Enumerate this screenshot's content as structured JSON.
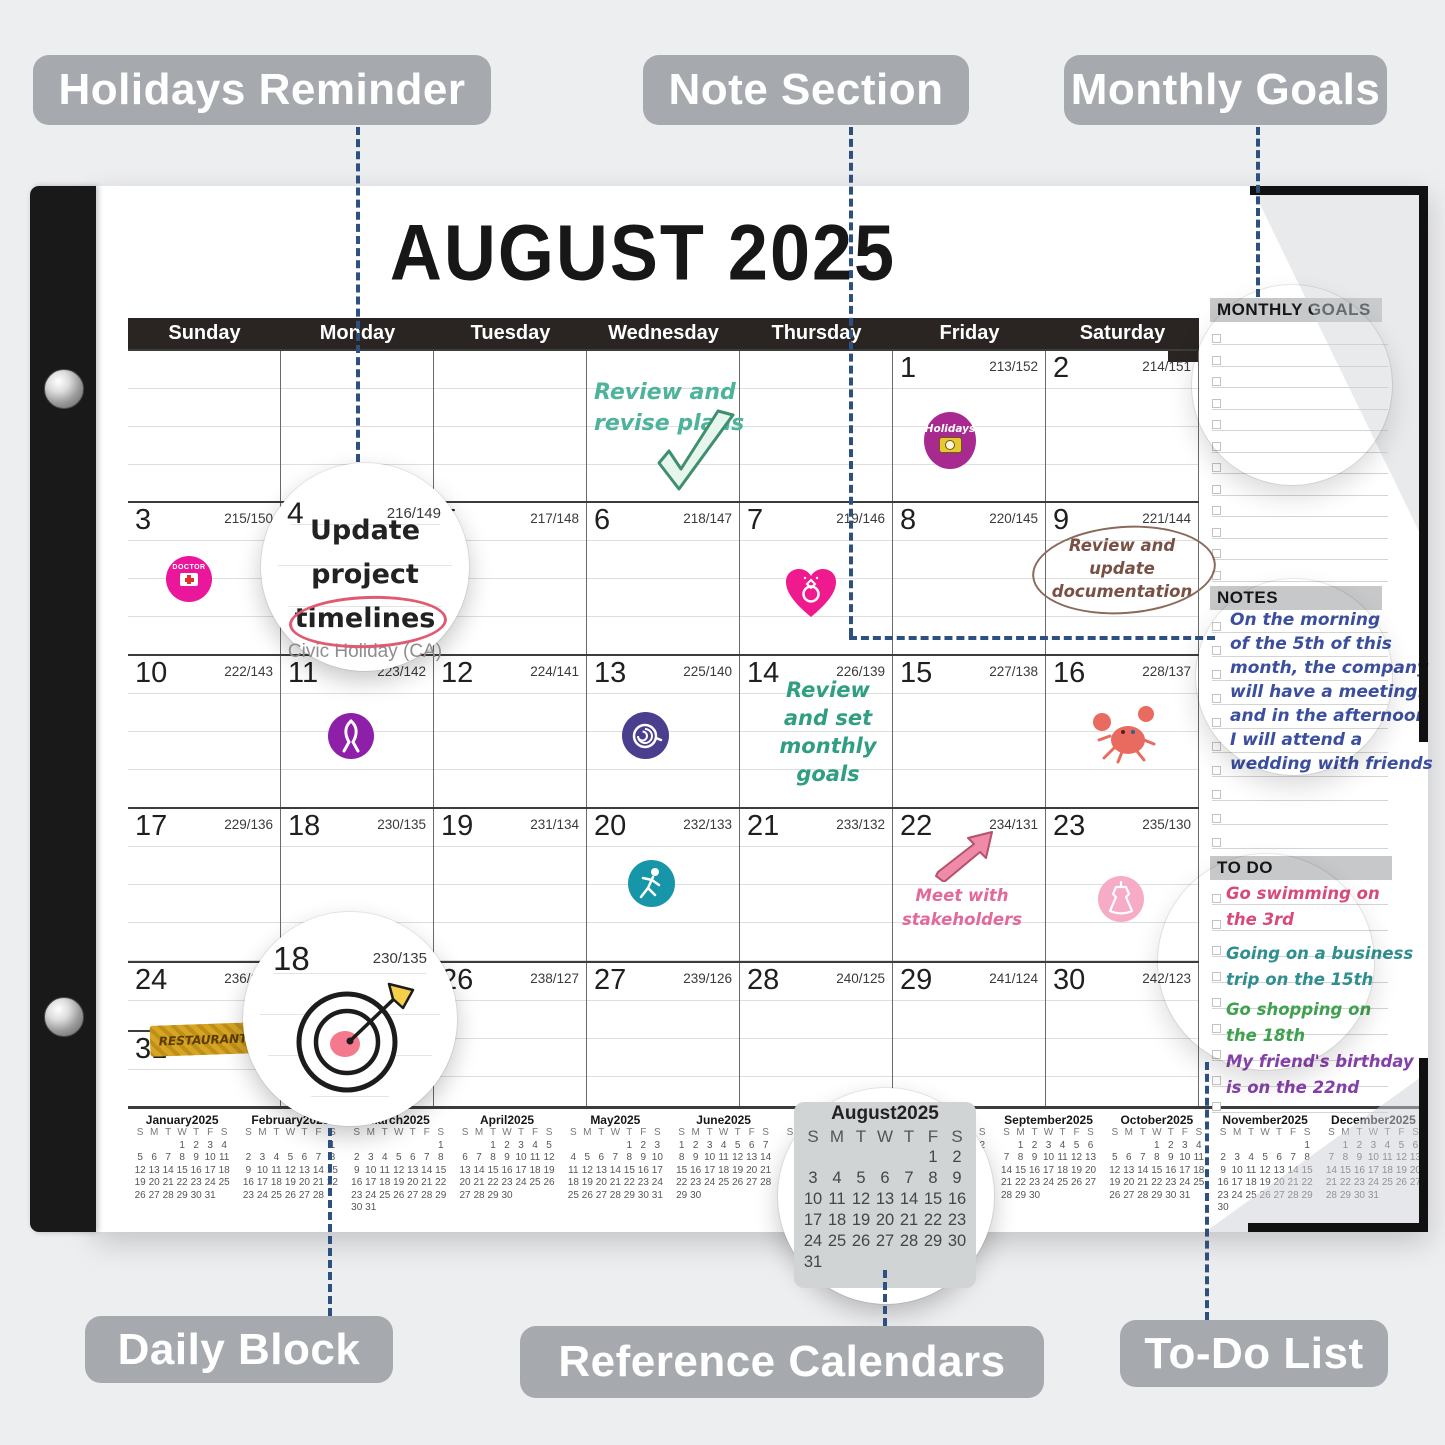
{
  "background": "#edeef0",
  "callouts": {
    "holidays_reminder": "Holidays Reminder",
    "note_section": "Note Section",
    "monthly_goals": "Monthly Goals",
    "daily_block": "Daily Block",
    "reference_calendars": "Reference Calendars",
    "todo_list": "To-Do List"
  },
  "calendar": {
    "title": "AUGUST 2025",
    "weekdays": [
      "Sunday",
      "Monday",
      "Tuesday",
      "Wednesday",
      "Thursday",
      "Friday",
      "Saturday"
    ],
    "weeks": [
      [
        null,
        null,
        null,
        null,
        null,
        {
          "day": "1",
          "code": "213/152"
        },
        {
          "day": "2",
          "code": "214/151"
        }
      ],
      [
        {
          "day": "3",
          "code": "215/150"
        },
        {
          "day": "4",
          "code": "216/149"
        },
        {
          "day": "5",
          "code": "217/148"
        },
        {
          "day": "6",
          "code": "218/147"
        },
        {
          "day": "7",
          "code": "219/146"
        },
        {
          "day": "8",
          "code": "220/145"
        },
        {
          "day": "9",
          "code": "221/144"
        }
      ],
      [
        {
          "day": "10",
          "code": "222/143"
        },
        {
          "day": "11",
          "code": "223/142"
        },
        {
          "day": "12",
          "code": "224/141"
        },
        {
          "day": "13",
          "code": "225/140"
        },
        {
          "day": "14",
          "code": "226/139"
        },
        {
          "day": "15",
          "code": "227/138"
        },
        {
          "day": "16",
          "code": "228/137"
        }
      ],
      [
        {
          "day": "17",
          "code": "229/136"
        },
        {
          "day": "18",
          "code": "230/135"
        },
        {
          "day": "19",
          "code": "231/134"
        },
        {
          "day": "20",
          "code": "232/133"
        },
        {
          "day": "21",
          "code": "233/132"
        },
        {
          "day": "22",
          "code": "234/131"
        },
        {
          "day": "23",
          "code": "235/130"
        }
      ],
      [
        {
          "day": "24",
          "code": "236/129"
        },
        {
          "day": "25",
          "code": "237/128"
        },
        {
          "day": "26",
          "code": "238/127"
        },
        {
          "day": "27",
          "code": "239/126"
        },
        {
          "day": "28",
          "code": "240/125"
        },
        {
          "day": "29",
          "code": "241/124"
        },
        {
          "day": "30",
          "code": "242/123"
        }
      ]
    ],
    "day31": {
      "day": "31",
      "code": "243/122"
    },
    "cell_notes": [
      {
        "id": "revise-plans",
        "lines": [
          "Review and",
          "revise plans"
        ],
        "color": "#4db39a"
      },
      {
        "id": "update-documentation",
        "lines": [
          "Review and",
          "update",
          "documentation"
        ],
        "color": "#7a5044"
      },
      {
        "id": "set-monthly-goals",
        "lines": [
          "Review",
          "and set",
          "monthly",
          "goals"
        ],
        "color": "#2f9e82"
      },
      {
        "id": "meet-stakeholders",
        "lines": [
          "Meet with",
          "stakeholders"
        ],
        "color": "#e2699c"
      }
    ]
  },
  "lenses": {
    "day4": {
      "day": "4",
      "code": "216/149",
      "note_lines": [
        "Update",
        "project",
        "timelines"
      ],
      "holiday": "Civic Holiday (CA)"
    },
    "day18": {
      "day": "18",
      "code": "230/135"
    }
  },
  "stickers": {
    "holidays": {
      "label": "Holidays",
      "color": "#a8298f"
    },
    "doctor": {
      "label": "DOCTOR",
      "color": "#ea179c"
    },
    "restaurant": {
      "label": "RESTAURANT",
      "color": "#d9a520"
    },
    "heart_ring_color": "#ee1a8e",
    "ribbon_color": "#8e1fa8",
    "coffee_color": "#4a3e8e",
    "crab_color": "#e96a5f",
    "runner_color": "#1795a9",
    "arrow_color": "#ef8aa8",
    "dress_color": "#f6abc6"
  },
  "side_panel": {
    "monthly_goals_title": "MONTHLY GOALS",
    "notes_title": "NOTES",
    "todo_title": "TO DO",
    "notes_color": "#3c4f9e",
    "notes_lines": [
      "On the morning",
      "of the 5th of this",
      "month, the company",
      "will have a meeting.",
      "and in the afternoon",
      "I will attend a",
      "wedding with friends"
    ],
    "todo_items": [
      {
        "lines": [
          "Go swimming on",
          "the 3rd"
        ],
        "color": "#d84b78"
      },
      {
        "lines": [
          "Going on a business",
          "trip on the 15th"
        ],
        "color": "#2f8f8f"
      },
      {
        "lines": [
          "Go shopping on",
          "the 18th"
        ],
        "color": "#3fa14f"
      },
      {
        "lines": [
          "My friend's birthday",
          "is on the 22nd"
        ],
        "color": "#8540a8"
      }
    ]
  },
  "mini_calendars": {
    "weekday_letters": [
      "S",
      "M",
      "T",
      "W",
      "T",
      "F",
      "S"
    ],
    "months": [
      {
        "label": "January2025",
        "first_day": 3,
        "days": 31
      },
      {
        "label": "February2025",
        "first_day": 6,
        "days": 28
      },
      {
        "label": "March2025",
        "first_day": 6,
        "days": 31
      },
      {
        "label": "April2025",
        "first_day": 2,
        "days": 30
      },
      {
        "label": "May2025",
        "first_day": 4,
        "days": 31
      },
      {
        "label": "June2025",
        "first_day": 0,
        "days": 30
      },
      {
        "label": "July2025",
        "first_day": 2,
        "days": 31
      },
      {
        "label": "August2025",
        "first_day": 5,
        "days": 31
      },
      {
        "label": "September2025",
        "first_day": 1,
        "days": 30
      },
      {
        "label": "October2025",
        "first_day": 3,
        "days": 31
      },
      {
        "label": "November2025",
        "first_day": 6,
        "days": 30
      },
      {
        "label": "December2025",
        "first_day": 1,
        "days": 31
      }
    ]
  }
}
